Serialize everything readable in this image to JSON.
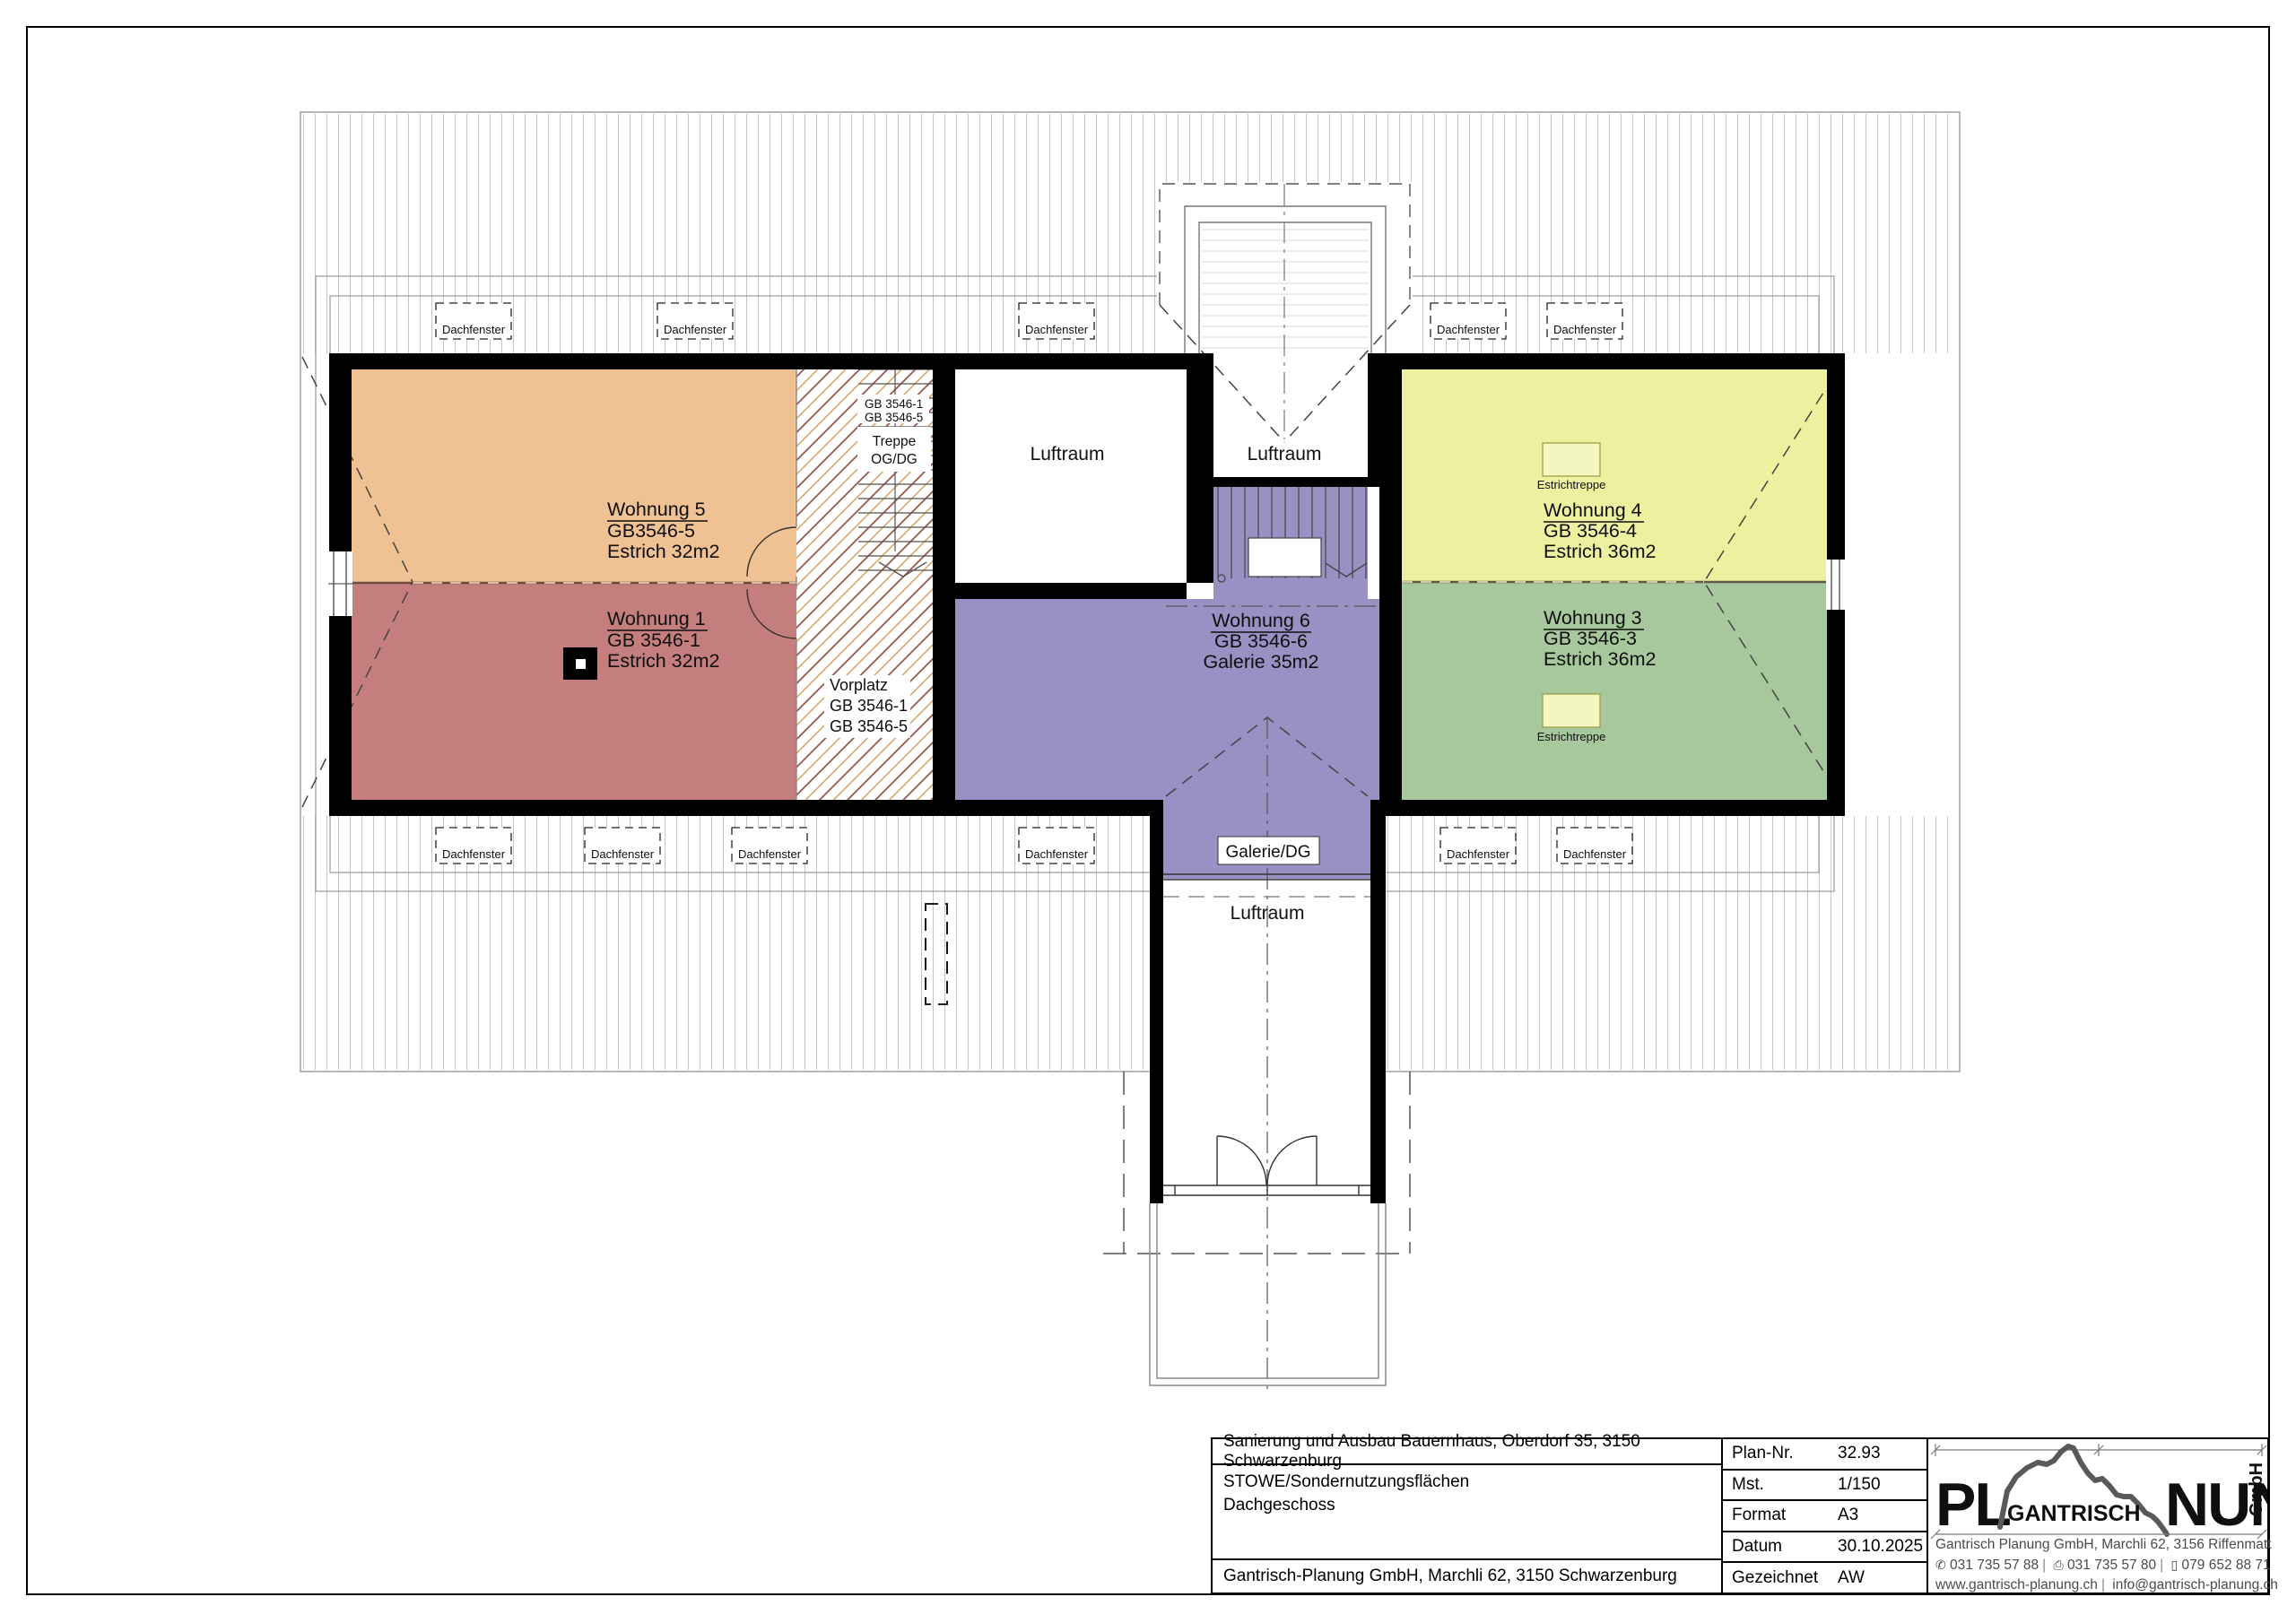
{
  "plan": {
    "rooms": {
      "w5": {
        "name": "Wohnung 5",
        "gb": "GB3546-5",
        "area": "Estrich 32m2",
        "color": "#f0c192"
      },
      "w1": {
        "name": "Wohnung 1",
        "gb": "GB 3546-1",
        "area": "Estrich 32m2",
        "color": "#c57e7e"
      },
      "w6": {
        "name": "Wohnung 6",
        "gb": "GB 3546-6",
        "area": "Galerie 35m2",
        "color": "#9a90c3"
      },
      "w4": {
        "name": "Wohnung 4",
        "gb": "GB 3546-4",
        "area": "Estrich 36m2",
        "color": "#edf09e"
      },
      "w3": {
        "name": "Wohnung 3",
        "gb": "GB 3546-3",
        "area": "Estrich 36m2",
        "color": "#a7c89c"
      }
    },
    "labels": {
      "dachfenster": "Dachfenster",
      "luftraum": "Luftraum",
      "estrichtreppe": "Estrichtreppe",
      "galerie_dg": "Galerie/DG",
      "treppe_line1": "Treppe",
      "treppe_line2": "OG/DG",
      "treppe_gb1": "GB 3546-1",
      "treppe_gb2": "GB 3546-5",
      "vorplatz": "Vorplatz",
      "vorplatz_gb1": "GB 3546-1",
      "vorplatz_gb2": "GB 3546-5"
    }
  },
  "titleblock": {
    "project": "Sanierung und Ausbau Bauernhaus, Oberdorf 35, 3150 Schwarzenburg",
    "subject_line1": "STOWE/Sondernutzungsflächen",
    "subject_line2": "Dachgeschoss",
    "company": "Gantrisch-Planung GmbH, Marchli 62, 3150 Schwarzenburg",
    "fields": [
      {
        "label": "Plan-Nr.",
        "value": "32.93"
      },
      {
        "label": "Mst.",
        "value": "1/150"
      },
      {
        "label": "Format",
        "value": "A3"
      },
      {
        "label": "Datum",
        "value": "30.10.2025"
      },
      {
        "label": "Gezeichnet",
        "value": "AW"
      }
    ],
    "logo": {
      "pl": "PL",
      "gantrisch": "GANTRISCH",
      "nung": "NUNG",
      "gmbh": "GmbH",
      "gray": "#58595b",
      "olive": "#a8a437",
      "address": "Gantrisch Planung GmbH, Marchli 62, 3156 Riffenmatt",
      "phone1": "031 735 57 88",
      "phone2": "031 735 57 80",
      "phone3": "079 652 88 71",
      "web": "www.gantrisch-planung.ch",
      "email": "info@gantrisch-planung.ch"
    },
    "icons": {
      "phone": "✆",
      "fax": "⎙",
      "mobile": "▯"
    }
  }
}
